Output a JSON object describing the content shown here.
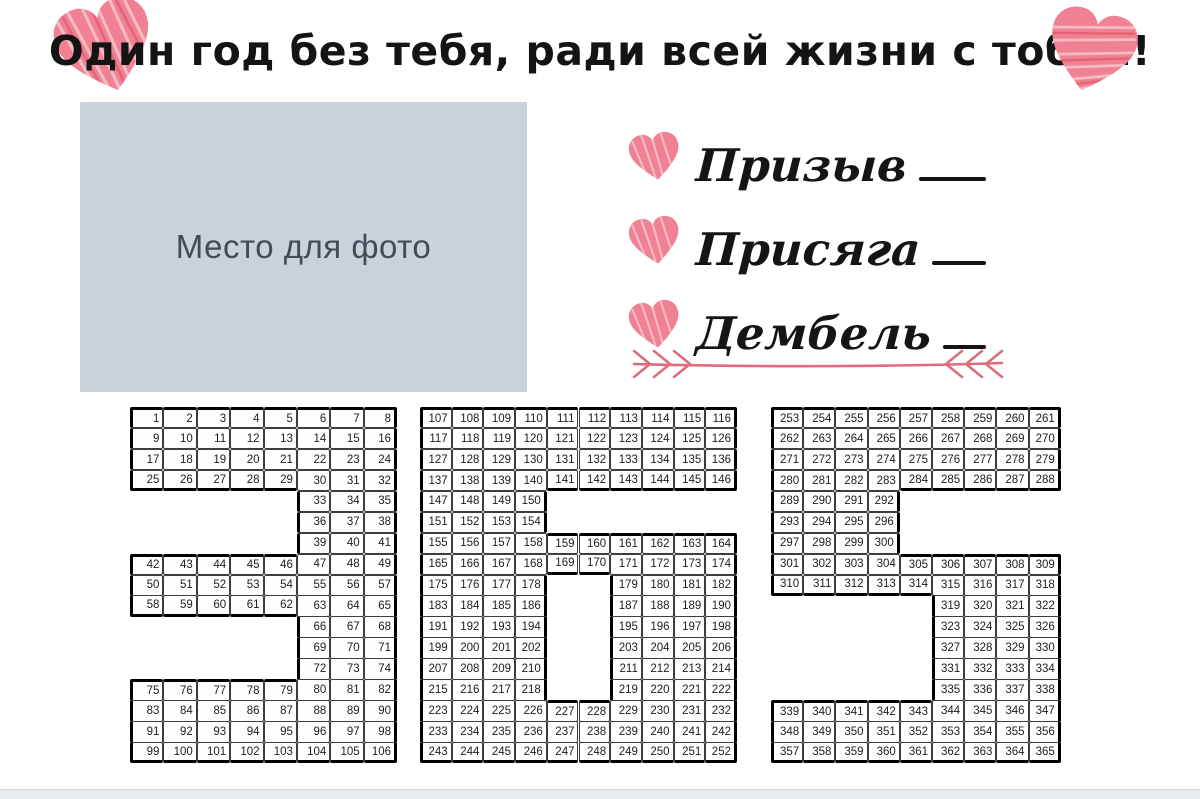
{
  "title": {
    "text": "Один год без тебя, ради всей жизни с тобой!"
  },
  "photo": {
    "label": "Место для фото"
  },
  "fields": [
    {
      "label": "Призыв",
      "value": ""
    },
    {
      "label": "Присяга",
      "value": ""
    },
    {
      "label": "Дембель",
      "value": ""
    }
  ],
  "calendar": {
    "total_days": 365,
    "digits": [
      {
        "digit": "3",
        "cols": 8,
        "start": 1,
        "end": 106,
        "row_masks": [
          "11111111",
          "11111111",
          "11111111",
          "11111111",
          "00000111",
          "00000111",
          "00000111",
          "11111111",
          "11111111",
          "11111111",
          "00000111",
          "00000111",
          "00000111",
          "11111111",
          "11111111",
          "11111111",
          "11111111"
        ]
      },
      {
        "digit": "6",
        "cols": 10,
        "start": 107,
        "end": 252,
        "row_masks": [
          "1111111111",
          "1111111111",
          "1111111111",
          "1111111111",
          "1111000000",
          "1111000000",
          "1111111111",
          "1111111111",
          "1111001111",
          "1111001111",
          "1111001111",
          "1111001111",
          "1111001111",
          "1111001111",
          "1111111111",
          "1111111111",
          "1111111111"
        ]
      },
      {
        "digit": "5",
        "cols": 9,
        "start": 253,
        "end": 365,
        "row_masks": [
          "111111111",
          "111111111",
          "111111111",
          "111111111",
          "111100000",
          "111100000",
          "111100000",
          "111111111",
          "111111111",
          "000001111",
          "000001111",
          "000001111",
          "000001111",
          "000001111",
          "111111111",
          "111111111",
          "111111111"
        ]
      }
    ]
  },
  "icons": {
    "scribble_heart": "scribble-heart-icon",
    "double_arrow": "double-ended-arrow-icon"
  },
  "colors": {
    "heart_pink": "#ef8193",
    "heart_pink_dark": "#e25b72",
    "arrow_pink": "#dd6d7c",
    "photo_bg": "#c9d2d9",
    "photo_text": "#414c59",
    "ink": "#141414",
    "cell_border": "#3d3d3d",
    "shape_border": "#000000",
    "bottom_strip": "#e8ebee"
  }
}
